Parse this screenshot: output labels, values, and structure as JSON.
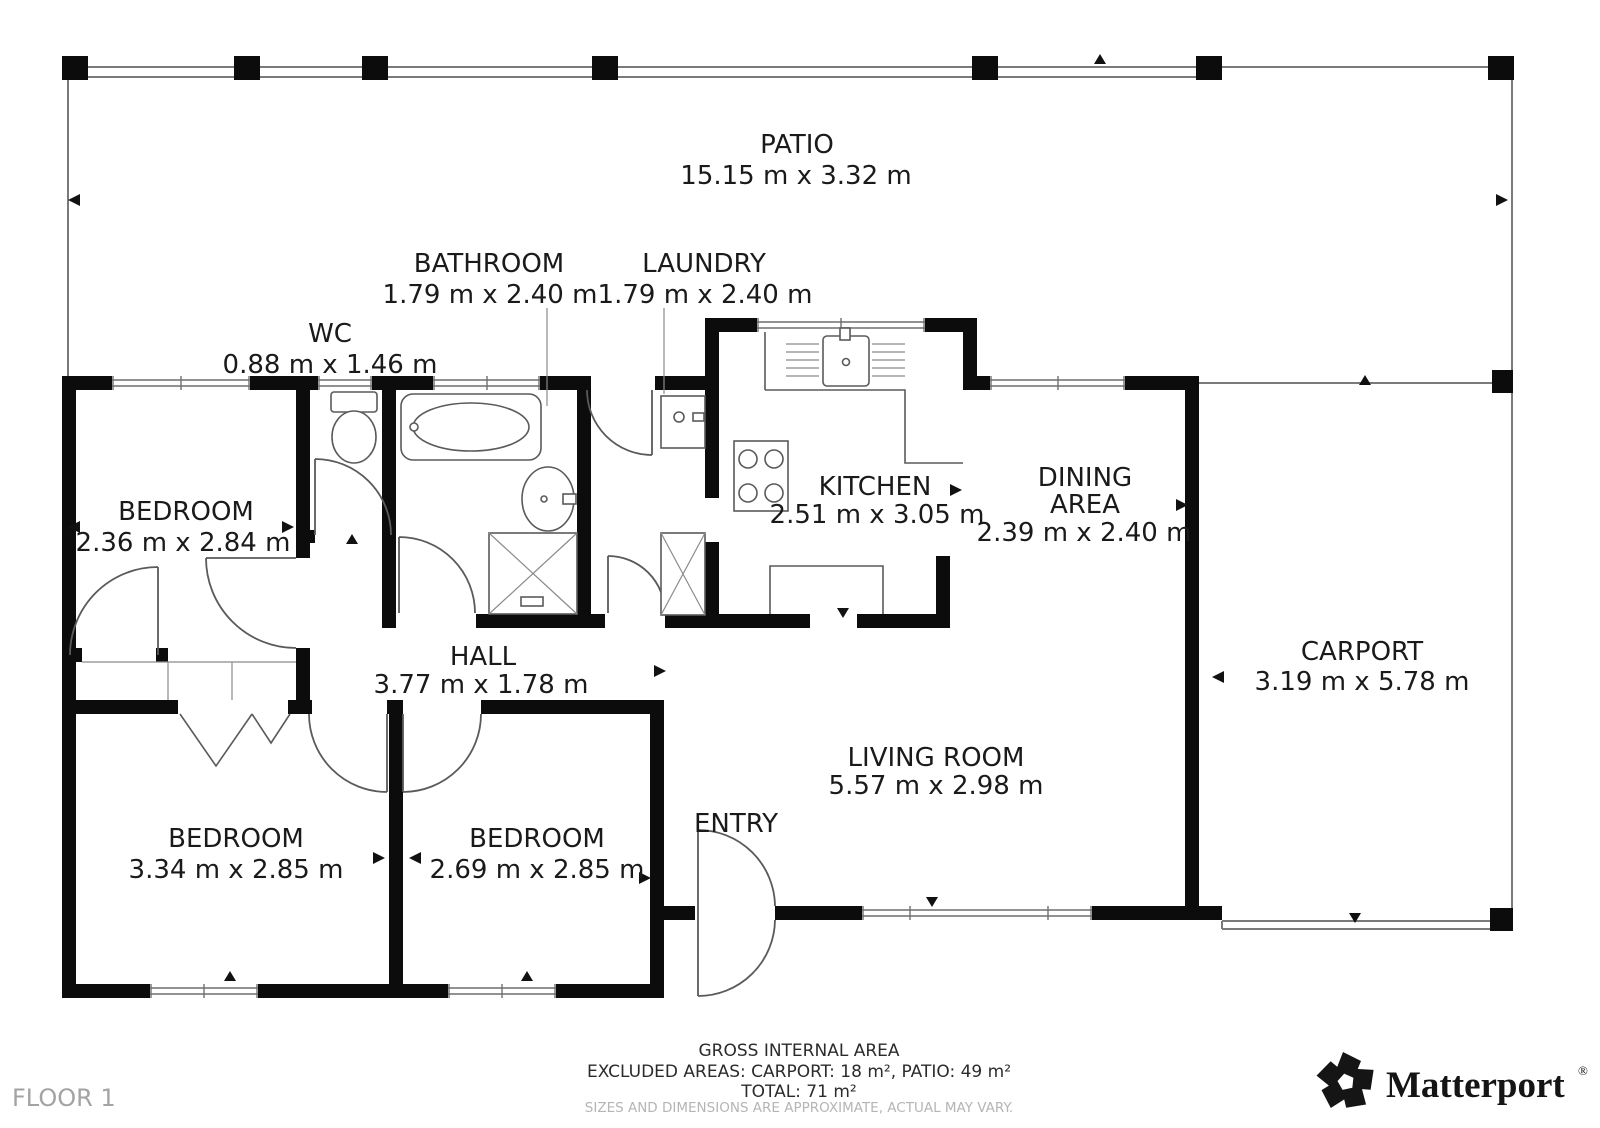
{
  "floor_label": "FLOOR 1",
  "rooms": [
    {
      "name": "PATIO",
      "dims": "15.15 m x 3.32 m"
    },
    {
      "name": "BATHROOM",
      "dims": "1.79 m x 2.40 m"
    },
    {
      "name": "LAUNDRY",
      "dims": "1.79 m x 2.40 m"
    },
    {
      "name": "WC",
      "dims": "0.88 m x 1.46 m"
    },
    {
      "name": "BEDROOM",
      "dims": "2.36 m x 2.84 m"
    },
    {
      "name": "KITCHEN",
      "dims": "2.51 m x 3.05 m"
    },
    {
      "name": "DINING AREA",
      "name_lines": [
        "DINING",
        "AREA"
      ],
      "dims": "2.39 m x 2.40 m"
    },
    {
      "name": "CARPORT",
      "dims": "3.19 m x 5.78 m"
    },
    {
      "name": "HALL",
      "dims": "3.77 m x 1.78 m"
    },
    {
      "name": "LIVING ROOM",
      "dims": "5.57 m x 2.98 m"
    },
    {
      "name": "BEDROOM",
      "dims": "3.34 m x 2.85 m"
    },
    {
      "name": "BEDROOM",
      "dims": "2.69 m x 2.85 m"
    },
    {
      "name": "ENTRY",
      "dims": ""
    }
  ],
  "footer": {
    "gross_heading": "GROSS INTERNAL AREA",
    "excluded": "EXCLUDED AREAS: CARPORT: 18 m², PATIO: 49 m²",
    "total": "TOTAL: 71 m²",
    "disclaimer": "SIZES AND DIMENSIONS ARE APPROXIMATE, ACTUAL MAY VARY."
  },
  "branding": {
    "logo_text": "Matterport",
    "registered_mark": "®",
    "logo_icon": "matterport-pinwheel-icon"
  },
  "colors": {
    "wall": "#0c0c0c",
    "line": "#5a5a5a",
    "text": "#1a1a1a",
    "muted": "#b5b5b5"
  }
}
